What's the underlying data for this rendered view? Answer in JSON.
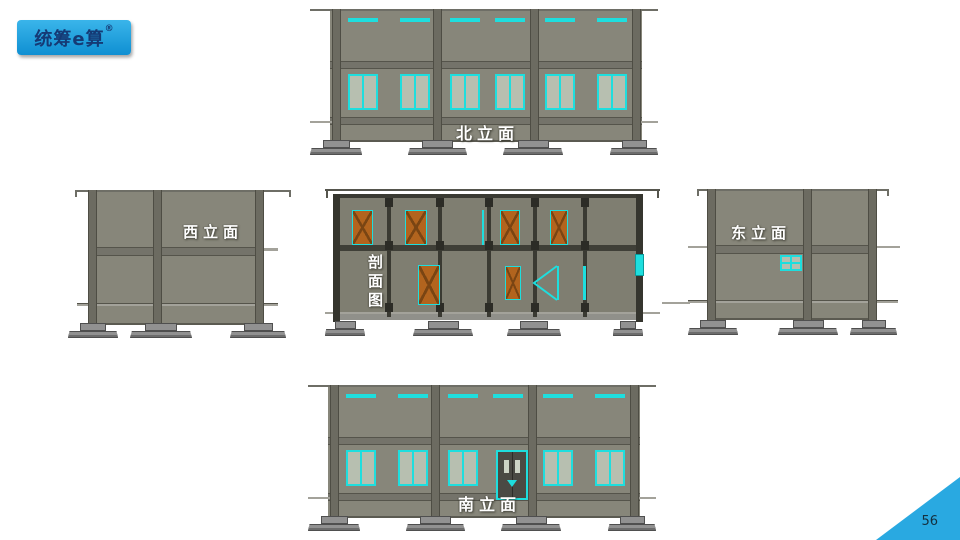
{
  "logo": {
    "text": "统筹e算",
    "registered": "®"
  },
  "page_number": "56",
  "views": {
    "north": {
      "label": "北立面",
      "type": "elevation",
      "floors": 2,
      "windows_upper": 6,
      "windows_lower": 6
    },
    "west": {
      "label": "西立面",
      "type": "elevation",
      "floors": 2,
      "windows_upper": 0,
      "windows_lower": 0
    },
    "section": {
      "label": "剖面图",
      "type": "section",
      "floors": 2,
      "doors_upper": 4,
      "doors_lower": 2
    },
    "east": {
      "label": "东立面",
      "type": "elevation",
      "floors": 2,
      "windows_upper": 0,
      "windows_lower": 1
    },
    "south": {
      "label": "南立面",
      "type": "elevation",
      "floors": 2,
      "windows_upper": 6,
      "windows_lower": 5,
      "has_entrance_door": true
    }
  },
  "colors": {
    "wall": "#87867a",
    "wall_section": "#7f7e71",
    "slab": "#74736a",
    "slab_edge": "#55544b",
    "column": "#6c6b61",
    "column_dark": "#3a3a32",
    "column_edge": "#4e4d44",
    "window_frame": "#1edede",
    "glass": "#b7bfb0",
    "door_orange": "#b2641e",
    "door_line": "#7a4513",
    "entrance_door": "#4a4a44",
    "footing": "#919191",
    "footing_edge": "#4f4f4f",
    "ledge": "#a3a29a",
    "ground": "#5b5a51",
    "roof_line": "#6e6e66",
    "corner_blue": "#29a9e1",
    "logo_bg_top": "#3ab5ea",
    "logo_bg_bottom": "#0f8fd2",
    "logo_text": "#153a75"
  }
}
